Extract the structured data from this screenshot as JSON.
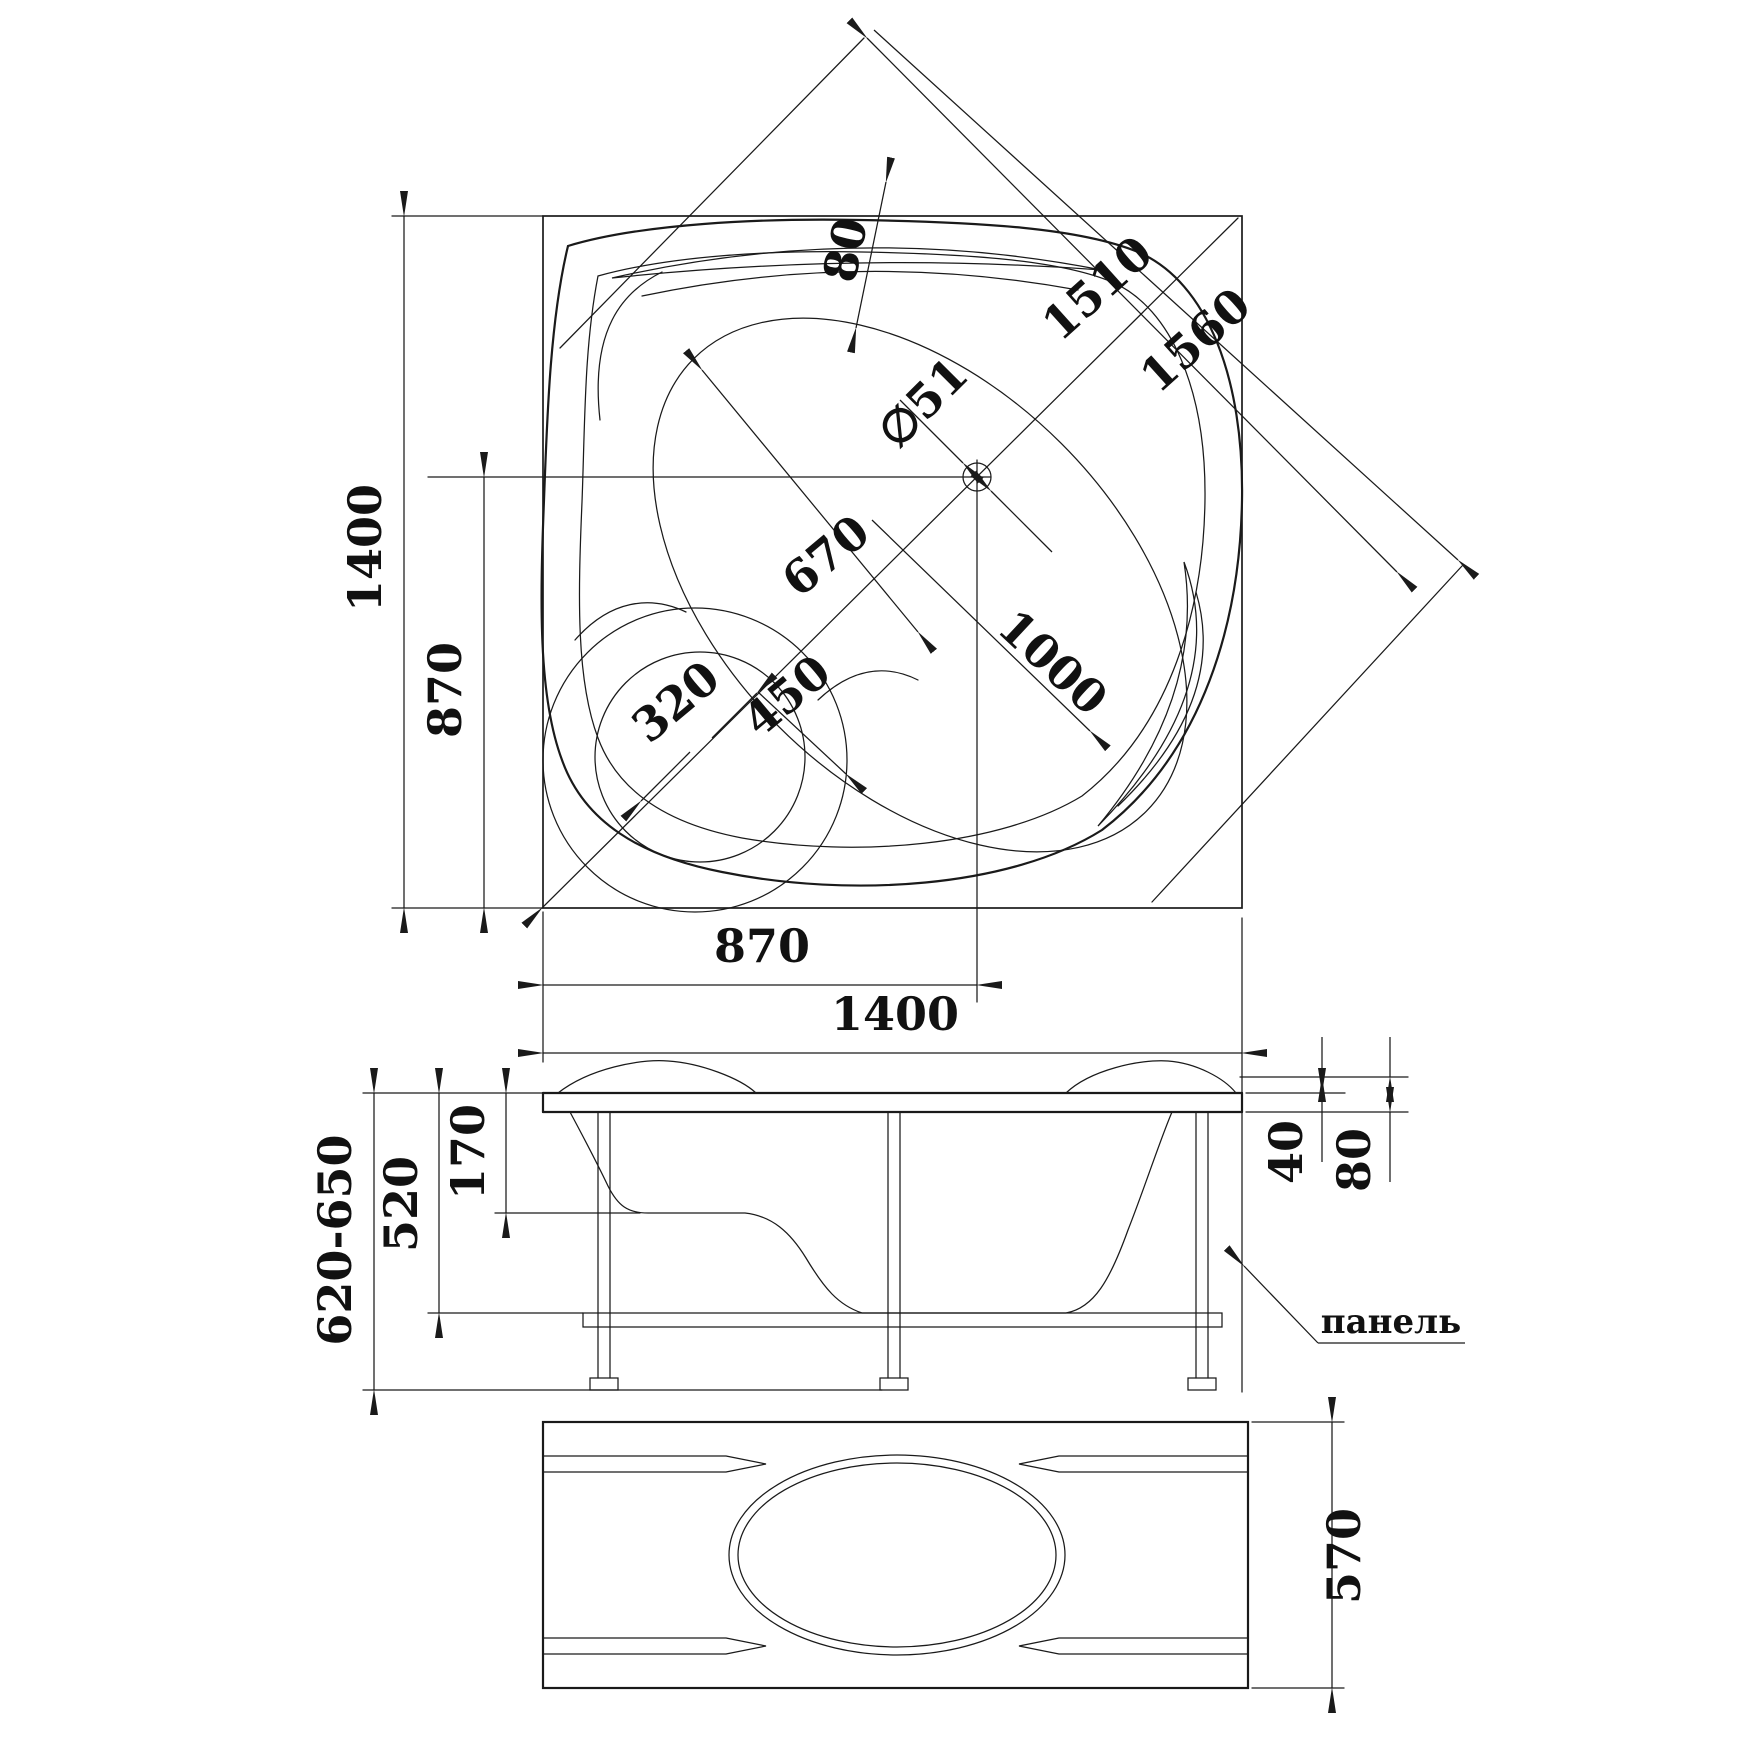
{
  "plan": {
    "width": "1400",
    "height": "1400",
    "drain_from_left": "870",
    "drain_from_bottom": "870",
    "diag_inner": "1510",
    "diag_outer": "1560",
    "rim_width": "80",
    "drain_diameter": "∅51",
    "bowl_width": "670",
    "bowl_length": "1000",
    "seat_width": "450",
    "corner_offset": "320"
  },
  "side": {
    "height_range": "620-650",
    "shell_height": "520",
    "seat_depth": "170",
    "lip_thickness": "40",
    "apron_height": "80",
    "panel_label": "панель"
  },
  "panel": {
    "height": "570"
  }
}
